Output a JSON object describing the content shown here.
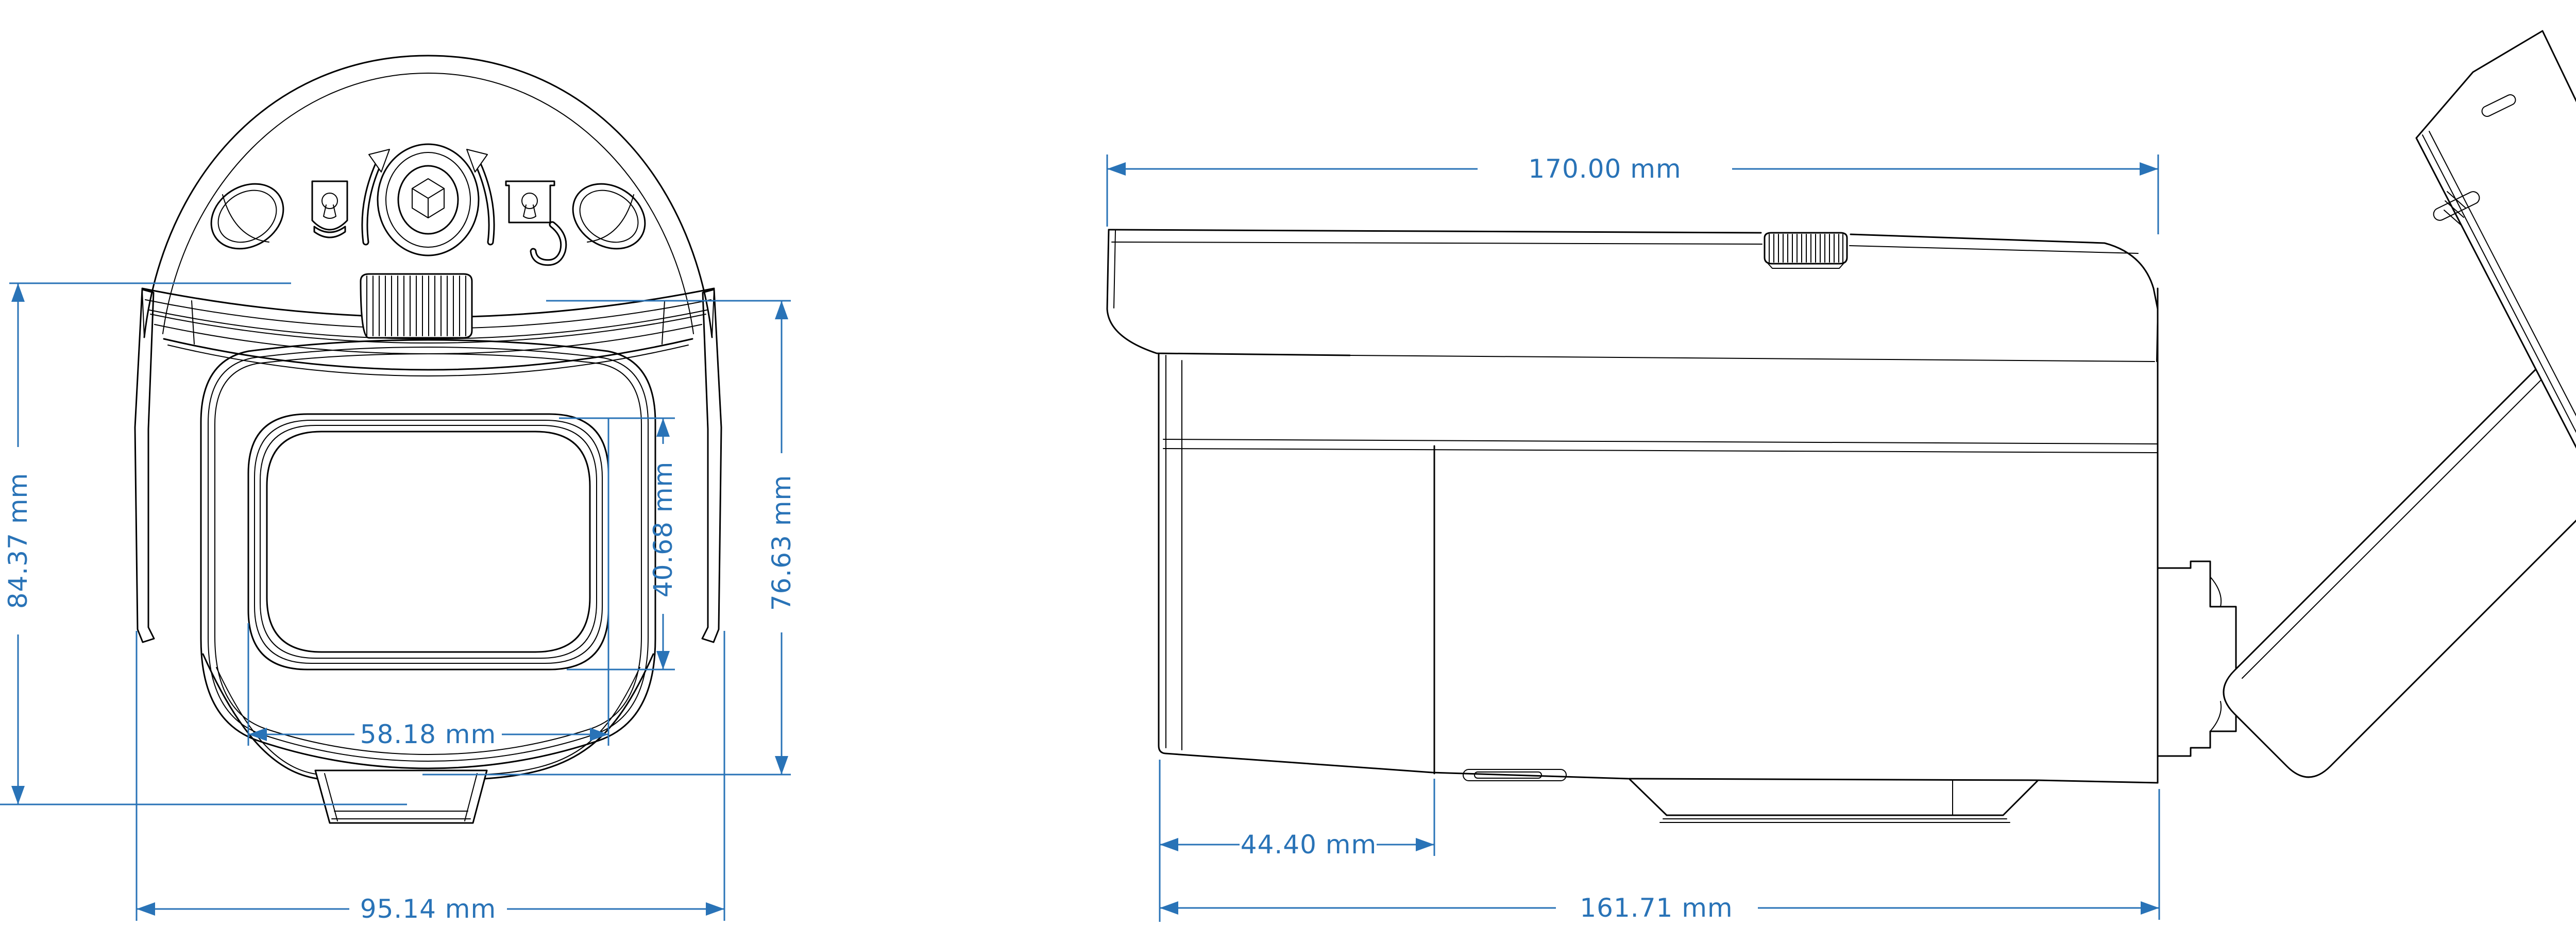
{
  "drawing_type": "camera technical dimension drawing",
  "views": {
    "front": {
      "dims": {
        "overall_height": "84.37 mm",
        "housing_height": "76.63 mm",
        "lens_window_height": "40.68 mm",
        "lens_window_width": "58.18 mm",
        "overall_width": "95.14 mm"
      }
    },
    "side": {
      "dims": {
        "overall_length": "170.00 mm",
        "front_section_length": "44.40 mm",
        "housing_length": "161.71 mm"
      }
    }
  },
  "colors": {
    "dimension": "#2973B7",
    "line": "#000000",
    "background": "#FFFFFF"
  }
}
